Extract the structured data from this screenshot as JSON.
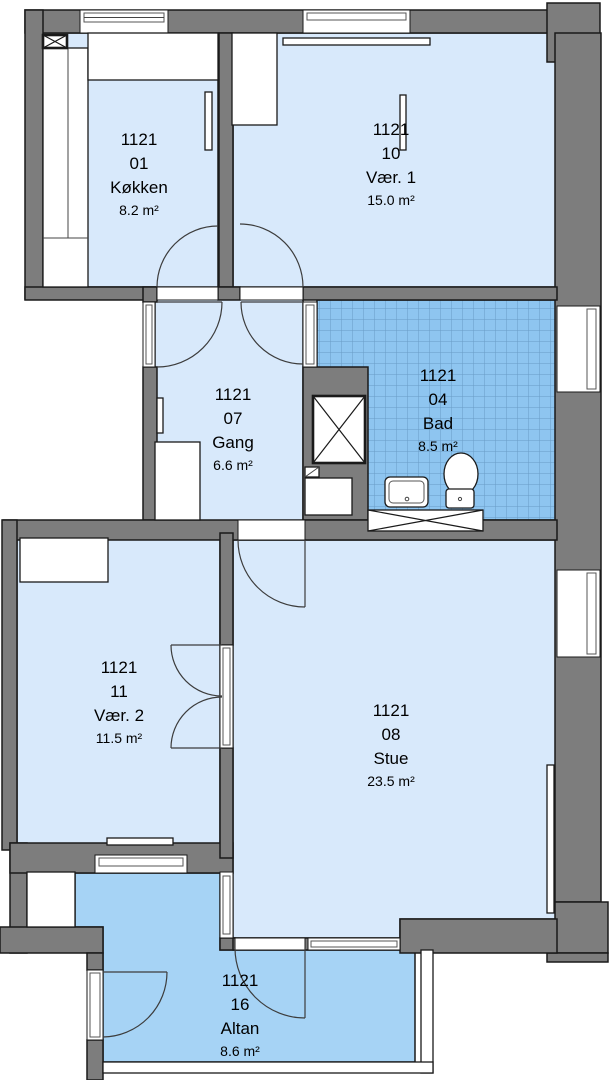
{
  "plan_title": "Apartment 1121 floor plan",
  "rooms": [
    {
      "building": "1121",
      "number": "01",
      "name": "Køkken",
      "area": "8.2 m²"
    },
    {
      "building": "1121",
      "number": "10",
      "name": "Vær. 1",
      "area": "15.0 m²"
    },
    {
      "building": "1121",
      "number": "07",
      "name": "Gang",
      "area": "6.6 m²"
    },
    {
      "building": "1121",
      "number": "04",
      "name": "Bad",
      "area": "8.5 m²"
    },
    {
      "building": "1121",
      "number": "11",
      "name": "Vær. 2",
      "area": "11.5 m²"
    },
    {
      "building": "1121",
      "number": "08",
      "name": "Stue",
      "area": "23.5 m²"
    },
    {
      "building": "1121",
      "number": "16",
      "name": "Altan",
      "area": "8.6 m²"
    }
  ],
  "colors": {
    "wall": "#7d7d7d",
    "outline": "#1a1a1a",
    "floor": "#d8e9fb",
    "tile": "#8ec5f0",
    "tile_line": "#689bc6",
    "balcony": "#a6d3f5",
    "door": "#3c3c3c"
  }
}
